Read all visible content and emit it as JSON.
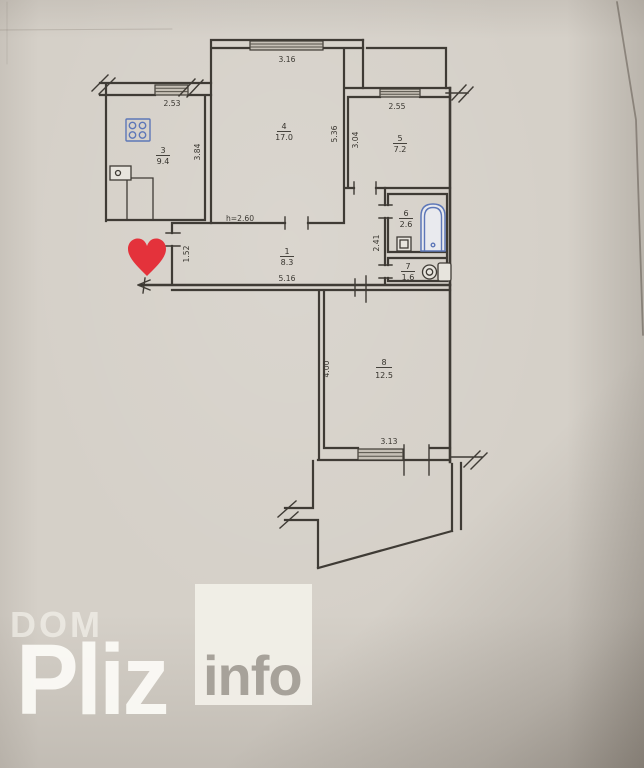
{
  "watermark": {
    "line1": "DOM",
    "line2": "Pliz",
    "line3": "info"
  },
  "plan": {
    "height_note": "h=2.60",
    "rooms": [
      {
        "num": "1",
        "area": "8.3"
      },
      {
        "num": "3",
        "area": "9.4"
      },
      {
        "num": "4",
        "area": "17.0"
      },
      {
        "num": "5",
        "area": "7.2"
      },
      {
        "num": "6",
        "area": "2.6"
      },
      {
        "num": "7",
        "area": "1.6"
      },
      {
        "num": "8",
        "area": "12.5"
      }
    ],
    "dims": {
      "room4_window": "3.16",
      "kitchen_top": "2.53",
      "room5_window": "2.55",
      "kitchen_side": "3.84",
      "room4_side": "5.36",
      "room5_side": "3.04",
      "hall_side": "1.52",
      "hall_width": "5.16",
      "wet_side": "2.41",
      "room8_side": "4.00",
      "room8_window": "3.13"
    },
    "fixtures": [
      "stove",
      "kitchen-sink",
      "bathtub",
      "wash-basin",
      "toilet"
    ],
    "colors": {
      "walls": "#3f3b35",
      "fixture_blue": "#5d77b8",
      "heart_red": "#e4323b",
      "paper": "#d5d0c8",
      "watermark_white": "#f1efe8",
      "info_gray": "#a7a29a"
    }
  }
}
